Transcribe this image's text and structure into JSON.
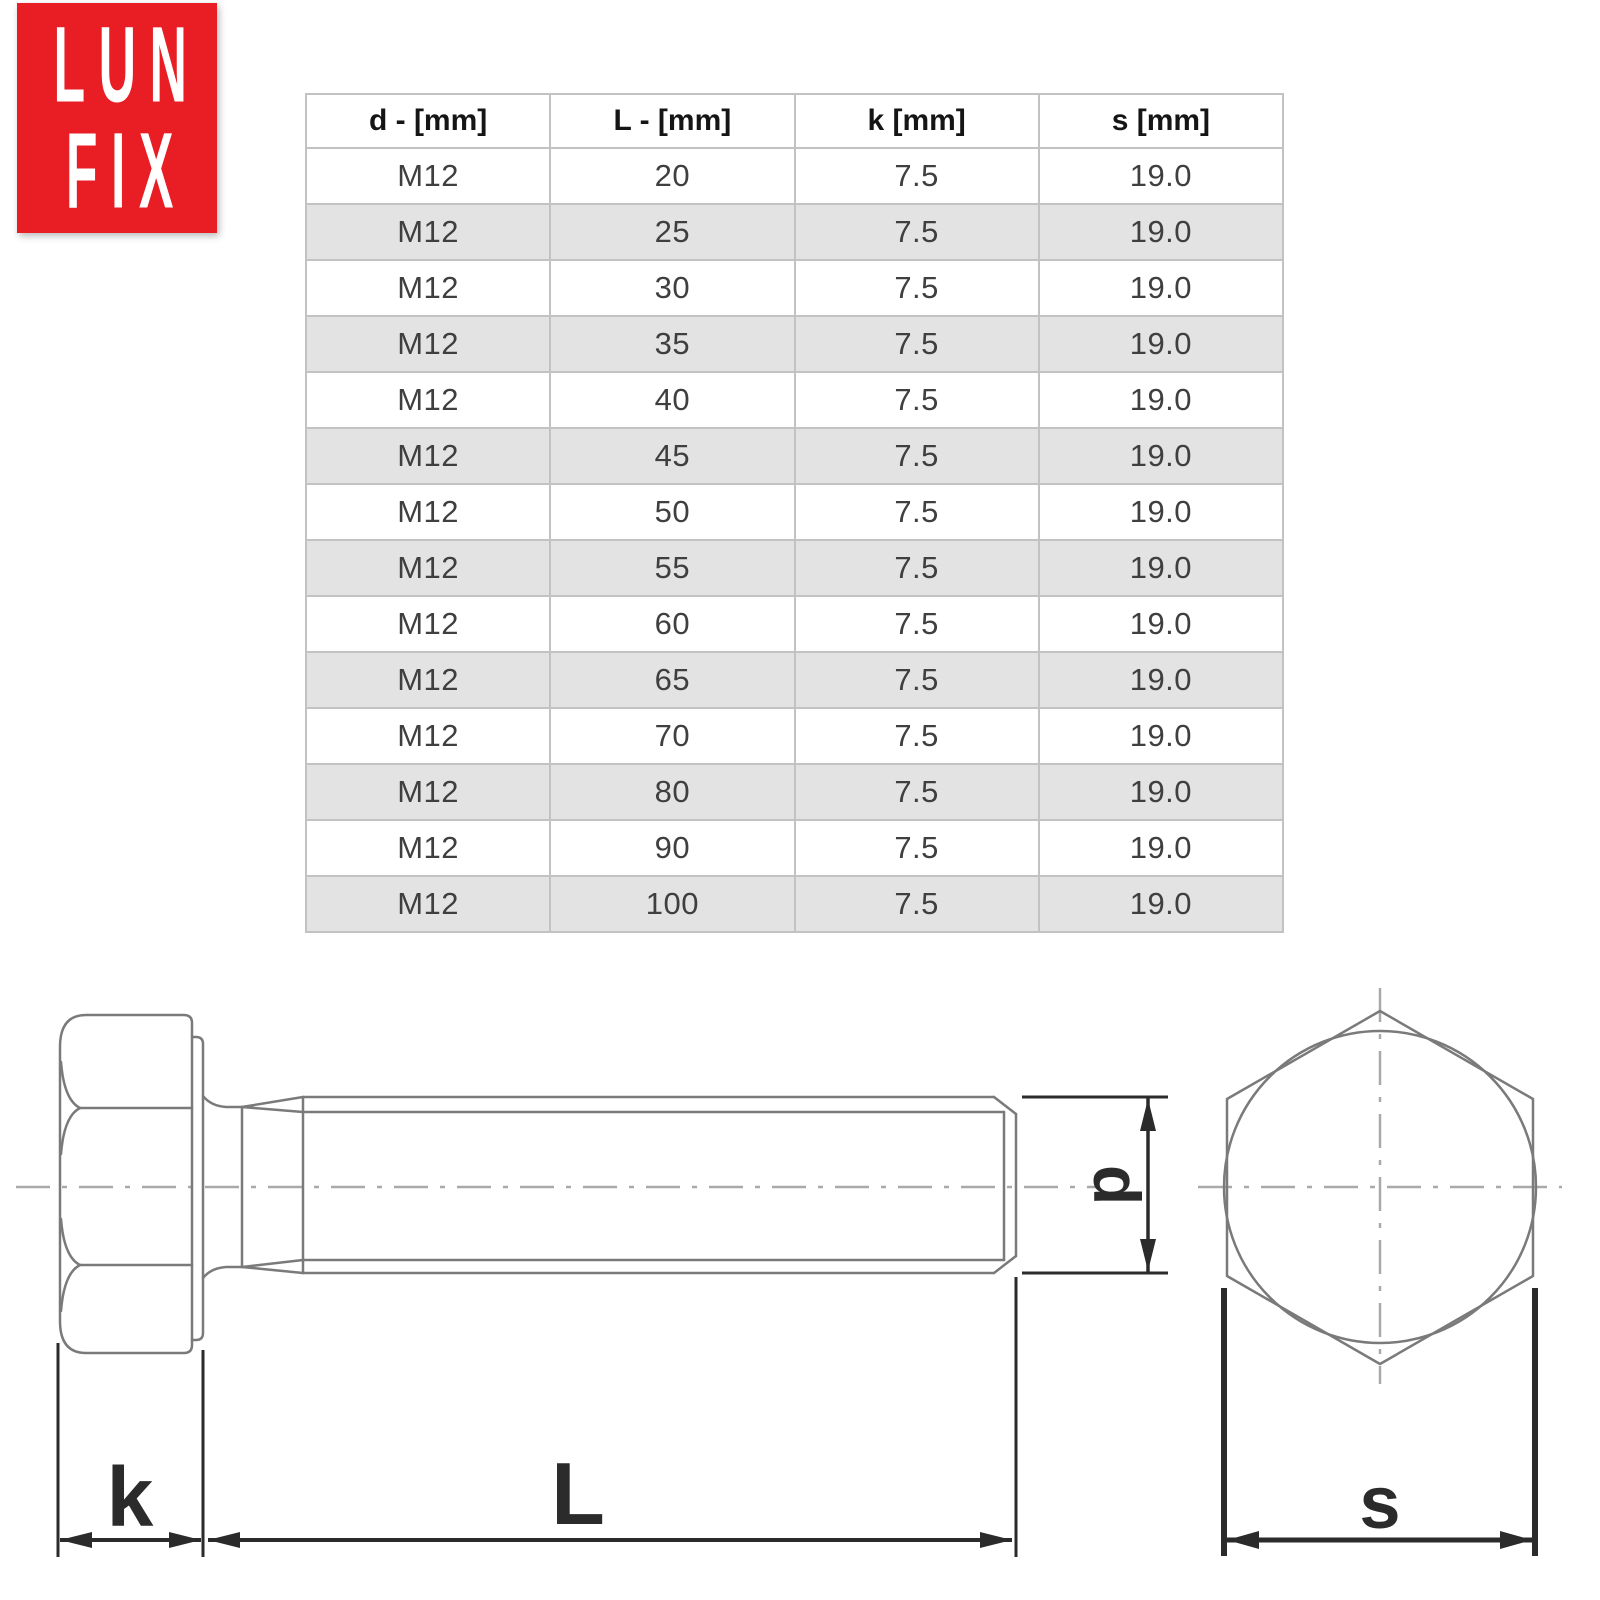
{
  "logo": {
    "line1": "LUN",
    "line2": "FIX"
  },
  "table": {
    "headers": [
      "d - [mm]",
      "L - [mm]",
      "k [mm]",
      "s [mm]"
    ],
    "rows": [
      [
        "M12",
        "20",
        "7.5",
        "19.0"
      ],
      [
        "M12",
        "25",
        "7.5",
        "19.0"
      ],
      [
        "M12",
        "30",
        "7.5",
        "19.0"
      ],
      [
        "M12",
        "35",
        "7.5",
        "19.0"
      ],
      [
        "M12",
        "40",
        "7.5",
        "19.0"
      ],
      [
        "M12",
        "45",
        "7.5",
        "19.0"
      ],
      [
        "M12",
        "50",
        "7.5",
        "19.0"
      ],
      [
        "M12",
        "55",
        "7.5",
        "19.0"
      ],
      [
        "M12",
        "60",
        "7.5",
        "19.0"
      ],
      [
        "M12",
        "65",
        "7.5",
        "19.0"
      ],
      [
        "M12",
        "70",
        "7.5",
        "19.0"
      ],
      [
        "M12",
        "80",
        "7.5",
        "19.0"
      ],
      [
        "M12",
        "90",
        "7.5",
        "19.0"
      ],
      [
        "M12",
        "100",
        "7.5",
        "19.0"
      ]
    ]
  },
  "drawing": {
    "labels": {
      "k": "k",
      "L": "L",
      "d": "d",
      "s": "s"
    }
  },
  "colors": {
    "logo_red": "#e81e24",
    "logo_text": "#ffffff",
    "row_alt": "#e3e3e3",
    "table_border": "#c2c2c2",
    "header_text": "#151515",
    "cell_text": "#3f3f3f",
    "outline_gray": "#7a7a7a",
    "centerline_gray": "#a9a9a9",
    "dimension_dark": "#2b2b2b"
  }
}
